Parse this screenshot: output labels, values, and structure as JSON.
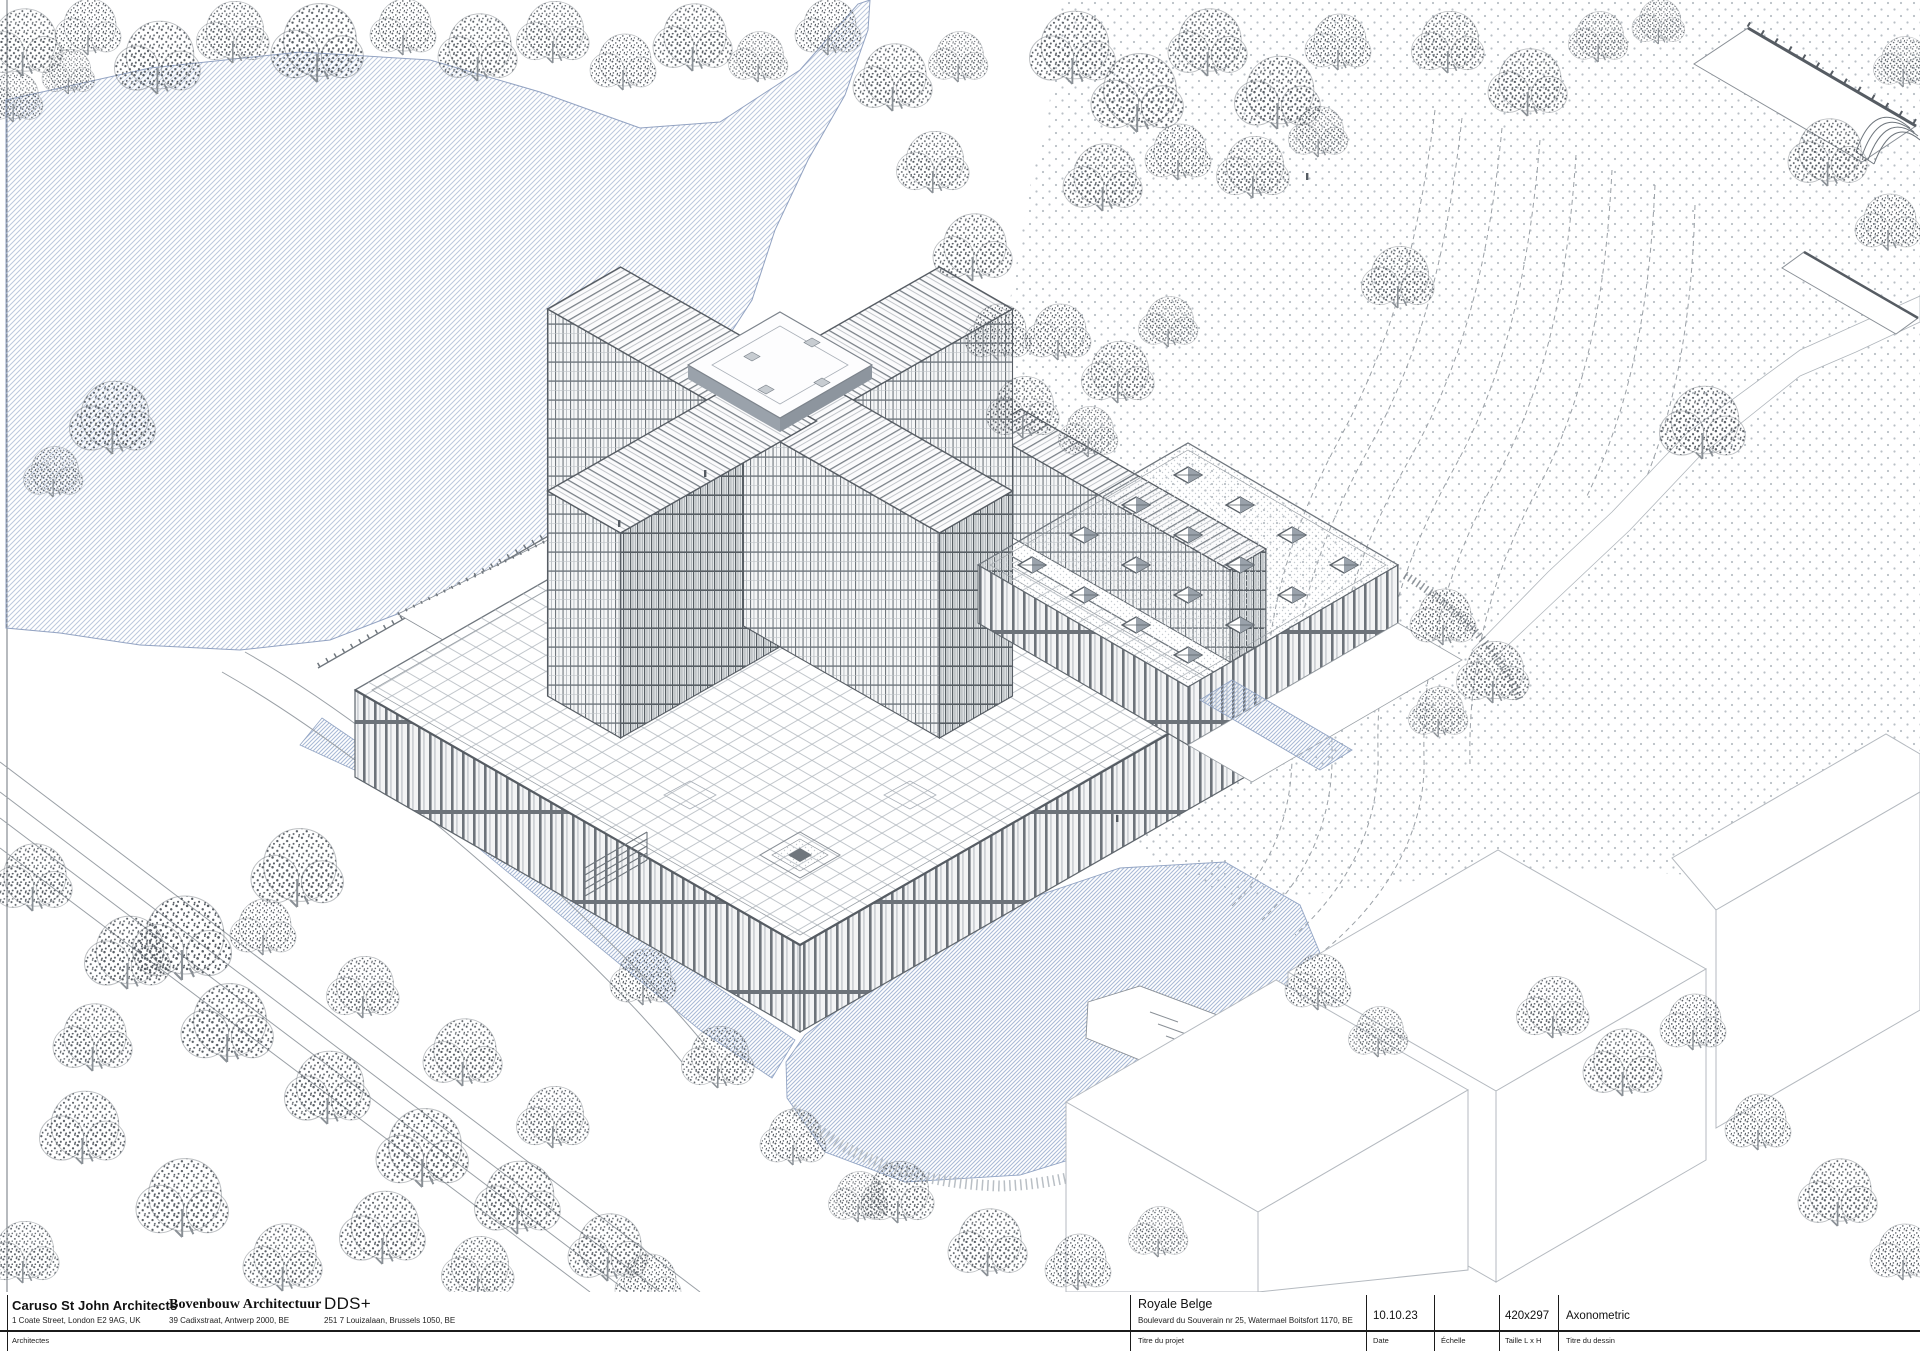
{
  "title_block": {
    "architects_label": "Architectes",
    "architects": [
      {
        "name": "Caruso St John Architects",
        "address": "1 Coate Street, London E2 9AG, UK"
      },
      {
        "name": "Bovenbouw Architectuur",
        "address": "39 Cadixstraat, Antwerp 2000, BE"
      },
      {
        "name": "DDS+",
        "address": "251 7 Louizalaan, Brussels 1050, BE"
      }
    ],
    "project": {
      "label": "Titre du projet",
      "name": "Royale Belge",
      "address": "Boulevard du Souverain nr 25, Watermael Boitsfort 1170, BE"
    },
    "date": {
      "label": "Date",
      "value": "10.10.23"
    },
    "scale": {
      "label": "Échelle",
      "value": ""
    },
    "size": {
      "label": "Taille L x H",
      "value": "420x297"
    },
    "drawing_title": {
      "label": "Titre du dessin",
      "value": "Axonometric"
    }
  },
  "drawing": {
    "subject": "Axonometric site view of the Royale Belge cruciform tower, podium, skylight hall, lake, ponds and wooded park",
    "palette": {
      "line_gray": "#6f767d",
      "dark_gray": "#565c63",
      "lake_blue": "#bcc8dd",
      "pond_blue": "#a9bad6",
      "stipple_gray": "#9aa0a6",
      "paper": "#ffffff"
    }
  }
}
